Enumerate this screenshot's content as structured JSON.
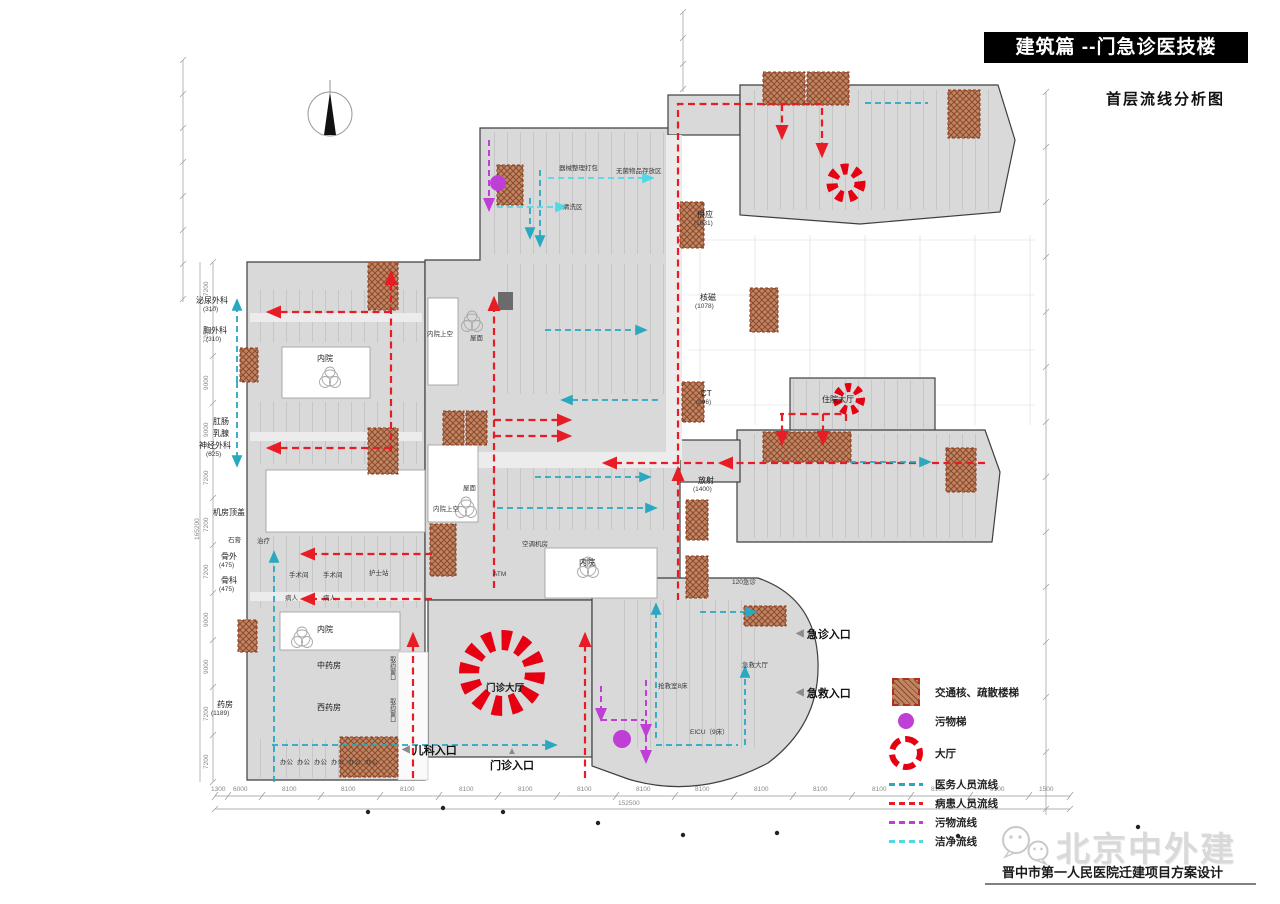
{
  "header": {
    "banner_title": "建筑篇 --门急诊医技楼",
    "subtitle": "首层流线分析图"
  },
  "colors": {
    "patient": "#e81c24",
    "staff": "#2aa8bf",
    "waste": "#bf3fd6",
    "clean": "#4fd8e8",
    "hall": "#e60012",
    "core": "#c08562",
    "coreline": "#8b4a2e",
    "banner": "#000000",
    "building": "#d9d9d9"
  },
  "plan": {
    "labels": [
      {
        "t": "泌尿外科",
        "x": 196,
        "y": 297
      },
      {
        "t": "(310)",
        "x": 203,
        "y": 306,
        "cls": "sm"
      },
      {
        "t": "胸外科",
        "x": 203,
        "y": 327
      },
      {
        "t": "(310)",
        "x": 206,
        "y": 336,
        "cls": "sm"
      },
      {
        "t": "肛肠",
        "x": 213,
        "y": 418
      },
      {
        "t": "乳腺",
        "x": 213,
        "y": 430
      },
      {
        "t": "神经外科",
        "x": 199,
        "y": 442
      },
      {
        "t": "(625)",
        "x": 206,
        "y": 451,
        "cls": "sm"
      },
      {
        "t": "机房顶盖",
        "x": 213,
        "y": 509
      },
      {
        "t": "骨外",
        "x": 221,
        "y": 553
      },
      {
        "t": "(475)",
        "x": 219,
        "y": 562,
        "cls": "sm"
      },
      {
        "t": "骨科",
        "x": 221,
        "y": 577
      },
      {
        "t": "(475)",
        "x": 219,
        "y": 586,
        "cls": "sm"
      },
      {
        "t": "药房",
        "x": 217,
        "y": 701
      },
      {
        "t": "(1189)",
        "x": 211,
        "y": 710,
        "cls": "sm"
      },
      {
        "t": "供应",
        "x": 697,
        "y": 211
      },
      {
        "t": "(1631)",
        "x": 694,
        "y": 220,
        "cls": "sm"
      },
      {
        "t": "核磁",
        "x": 700,
        "y": 294
      },
      {
        "t": "(1078)",
        "x": 695,
        "y": 303,
        "cls": "sm"
      },
      {
        "t": "CT",
        "x": 701,
        "y": 390
      },
      {
        "t": "(896)",
        "x": 696,
        "y": 399,
        "cls": "sm"
      },
      {
        "t": "住院大厅",
        "x": 822,
        "y": 396
      },
      {
        "t": "放射",
        "x": 698,
        "y": 477
      },
      {
        "t": "(1400)",
        "x": 693,
        "y": 486,
        "cls": "sm"
      },
      {
        "t": "门诊大厅",
        "x": 486,
        "y": 684,
        "cls": "md"
      },
      {
        "t": "内院",
        "x": 317,
        "y": 355
      },
      {
        "t": "内院",
        "x": 579,
        "y": 559
      },
      {
        "t": "内院",
        "x": 317,
        "y": 626
      },
      {
        "t": "内院上空",
        "x": 427,
        "y": 331,
        "cls": "sm"
      },
      {
        "t": "内院上空",
        "x": 433,
        "y": 506,
        "cls": "sm"
      },
      {
        "t": "屋面",
        "x": 470,
        "y": 335,
        "cls": "sm"
      },
      {
        "t": "屋面",
        "x": 463,
        "y": 485,
        "cls": "sm"
      },
      {
        "t": "中药房",
        "x": 317,
        "y": 662
      },
      {
        "t": "西药房",
        "x": 317,
        "y": 704
      },
      {
        "t": "空调机房",
        "x": 522,
        "y": 541,
        "cls": "sm"
      },
      {
        "t": "ATM",
        "x": 493,
        "y": 571,
        "cls": "sm"
      },
      {
        "t": "急救大厅",
        "x": 742,
        "y": 662,
        "cls": "sm"
      },
      {
        "t": "抢救室8床",
        "x": 658,
        "y": 683,
        "cls": "sm"
      },
      {
        "t": "EICU（9床）",
        "x": 690,
        "y": 729,
        "cls": "sm"
      },
      {
        "t": "120急诊",
        "x": 732,
        "y": 579,
        "cls": "sm"
      },
      {
        "t": "器械整理打包",
        "x": 559,
        "y": 165,
        "cls": "sm"
      },
      {
        "t": "无菌物品存放区",
        "x": 616,
        "y": 168,
        "cls": "sm"
      },
      {
        "t": "清洗区",
        "x": 563,
        "y": 204,
        "cls": "sm"
      },
      {
        "t": "石膏",
        "x": 228,
        "y": 537,
        "cls": "sm"
      },
      {
        "t": "治疗",
        "x": 257,
        "y": 538,
        "cls": "sm"
      },
      {
        "t": "手术间",
        "x": 289,
        "y": 572,
        "cls": "sm"
      },
      {
        "t": "手术间",
        "x": 323,
        "y": 572,
        "cls": "sm"
      },
      {
        "t": "护士站",
        "x": 369,
        "y": 570,
        "cls": "sm"
      },
      {
        "t": "病人",
        "x": 285,
        "y": 595,
        "cls": "sm"
      },
      {
        "t": "病人",
        "x": 323,
        "y": 595,
        "cls": "sm"
      },
      {
        "t": "办公",
        "x": 280,
        "y": 759,
        "cls": "sm"
      },
      {
        "t": "办公",
        "x": 297,
        "y": 759,
        "cls": "sm"
      },
      {
        "t": "办公",
        "x": 314,
        "y": 759,
        "cls": "sm"
      },
      {
        "t": "办公",
        "x": 331,
        "y": 759,
        "cls": "sm"
      },
      {
        "t": "办公",
        "x": 348,
        "y": 759,
        "cls": "sm"
      },
      {
        "t": "办公",
        "x": 365,
        "y": 759,
        "cls": "sm"
      },
      {
        "t": "取药窗口",
        "x": 388,
        "y": 656,
        "cls": "vert"
      },
      {
        "t": "取药窗口",
        "x": 388,
        "y": 698,
        "cls": "vert"
      }
    ],
    "entrances": [
      {
        "t": "儿科入口",
        "marker": "◀",
        "x": 402,
        "y": 742,
        "cls": "left"
      },
      {
        "t": "门诊入口",
        "marker": "▲",
        "x": 490,
        "y": 747,
        "cls": "up"
      },
      {
        "t": "急诊入口",
        "marker": "◀",
        "x": 796,
        "y": 626,
        "cls": "left"
      },
      {
        "t": "急救入口",
        "marker": "◀",
        "x": 796,
        "y": 685,
        "cls": "left"
      }
    ]
  },
  "legend": {
    "items": [
      {
        "label": "交通核、疏散楼梯",
        "cls": "core"
      },
      {
        "label": "污物梯",
        "cls": "dot"
      },
      {
        "label": "大厅",
        "cls": "hall"
      },
      {
        "label": "医务人员流线",
        "cls": "line staff"
      },
      {
        "label": "病患人员流线",
        "cls": "line patient"
      },
      {
        "label": "污物流线",
        "cls": "line waste"
      },
      {
        "label": "洁净流线",
        "cls": "line clean"
      }
    ]
  },
  "dims": {
    "bottom": [
      {
        "t": "1300",
        "x": 211,
        "y": 786
      },
      {
        "t": "6000",
        "x": 233,
        "y": 786
      },
      {
        "t": "8100",
        "x": 282,
        "y": 786
      },
      {
        "t": "8100",
        "x": 341,
        "y": 786
      },
      {
        "t": "8100",
        "x": 400,
        "y": 786
      },
      {
        "t": "8100",
        "x": 459,
        "y": 786
      },
      {
        "t": "8100",
        "x": 518,
        "y": 786
      },
      {
        "t": "8100",
        "x": 577,
        "y": 786
      },
      {
        "t": "8100",
        "x": 636,
        "y": 786
      },
      {
        "t": "8100",
        "x": 695,
        "y": 786
      },
      {
        "t": "8100",
        "x": 754,
        "y": 786
      },
      {
        "t": "8100",
        "x": 813,
        "y": 786
      },
      {
        "t": "8100",
        "x": 872,
        "y": 786
      },
      {
        "t": "8100",
        "x": 931,
        "y": 786
      },
      {
        "t": "8100",
        "x": 990,
        "y": 786
      },
      {
        "t": "1500",
        "x": 1039,
        "y": 786
      }
    ],
    "bottom_total": "152500",
    "left": [
      {
        "t": "7200",
        "x": 203,
        "y": 296,
        "cls": "rot"
      },
      {
        "t": "7200",
        "x": 203,
        "y": 343,
        "cls": "rot"
      },
      {
        "t": "9000",
        "x": 203,
        "y": 390,
        "cls": "rot"
      },
      {
        "t": "9000",
        "x": 203,
        "y": 437,
        "cls": "rot"
      },
      {
        "t": "7200",
        "x": 203,
        "y": 485,
        "cls": "rot"
      },
      {
        "t": "7200",
        "x": 203,
        "y": 532,
        "cls": "rot"
      },
      {
        "t": "7200",
        "x": 203,
        "y": 579,
        "cls": "rot"
      },
      {
        "t": "9000",
        "x": 203,
        "y": 627,
        "cls": "rot"
      },
      {
        "t": "9000",
        "x": 203,
        "y": 674,
        "cls": "rot"
      },
      {
        "t": "7200",
        "x": 203,
        "y": 721,
        "cls": "rot"
      },
      {
        "t": "7200",
        "x": 203,
        "y": 769,
        "cls": "rot"
      }
    ],
    "left_total": "165200"
  },
  "footer": {
    "brand": "北京中外建",
    "project": "晋中市第一人民医院迁建项目方案设计"
  }
}
